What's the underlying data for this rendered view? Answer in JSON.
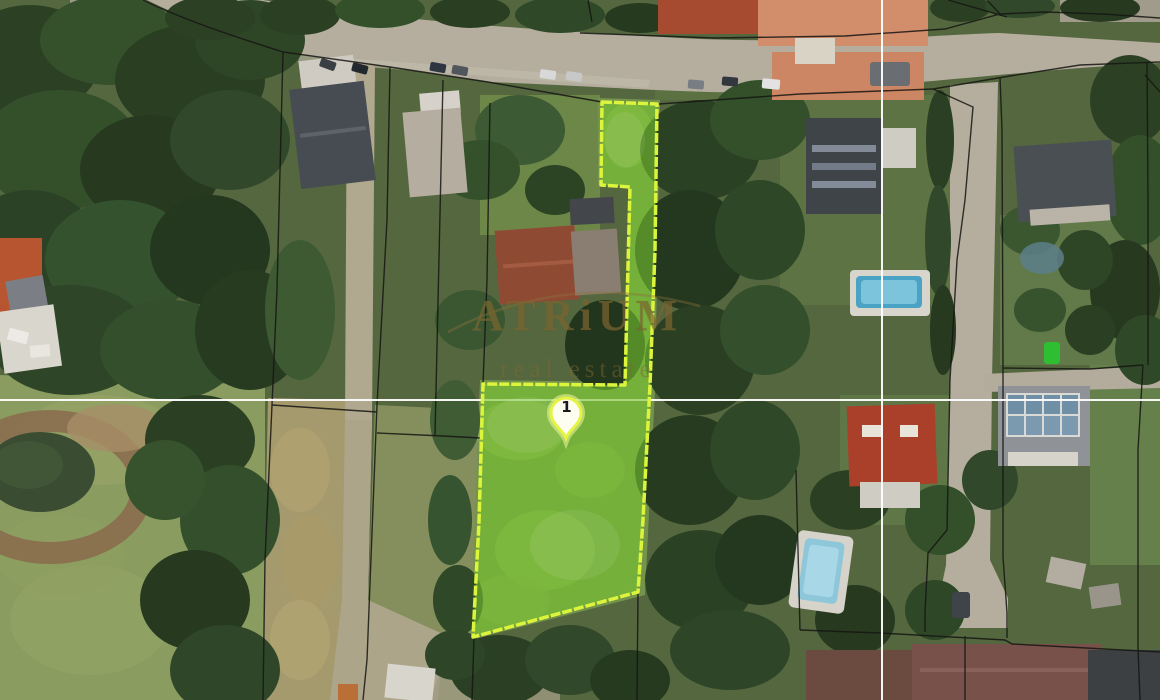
{
  "watermark": {
    "brand": "ATRiUM",
    "tagline": "real estate"
  },
  "parcel": {
    "marker_label": "1"
  },
  "colors": {
    "parcel_fill": "#76c32f",
    "parcel_outline": "#ddf43c",
    "boundary_line": "#161613",
    "crosshair": "#ffffff",
    "watermark_gold": "#80693 2",
    "marker_fill": "#fdfdf0",
    "marker_outline": "#e4f440"
  }
}
